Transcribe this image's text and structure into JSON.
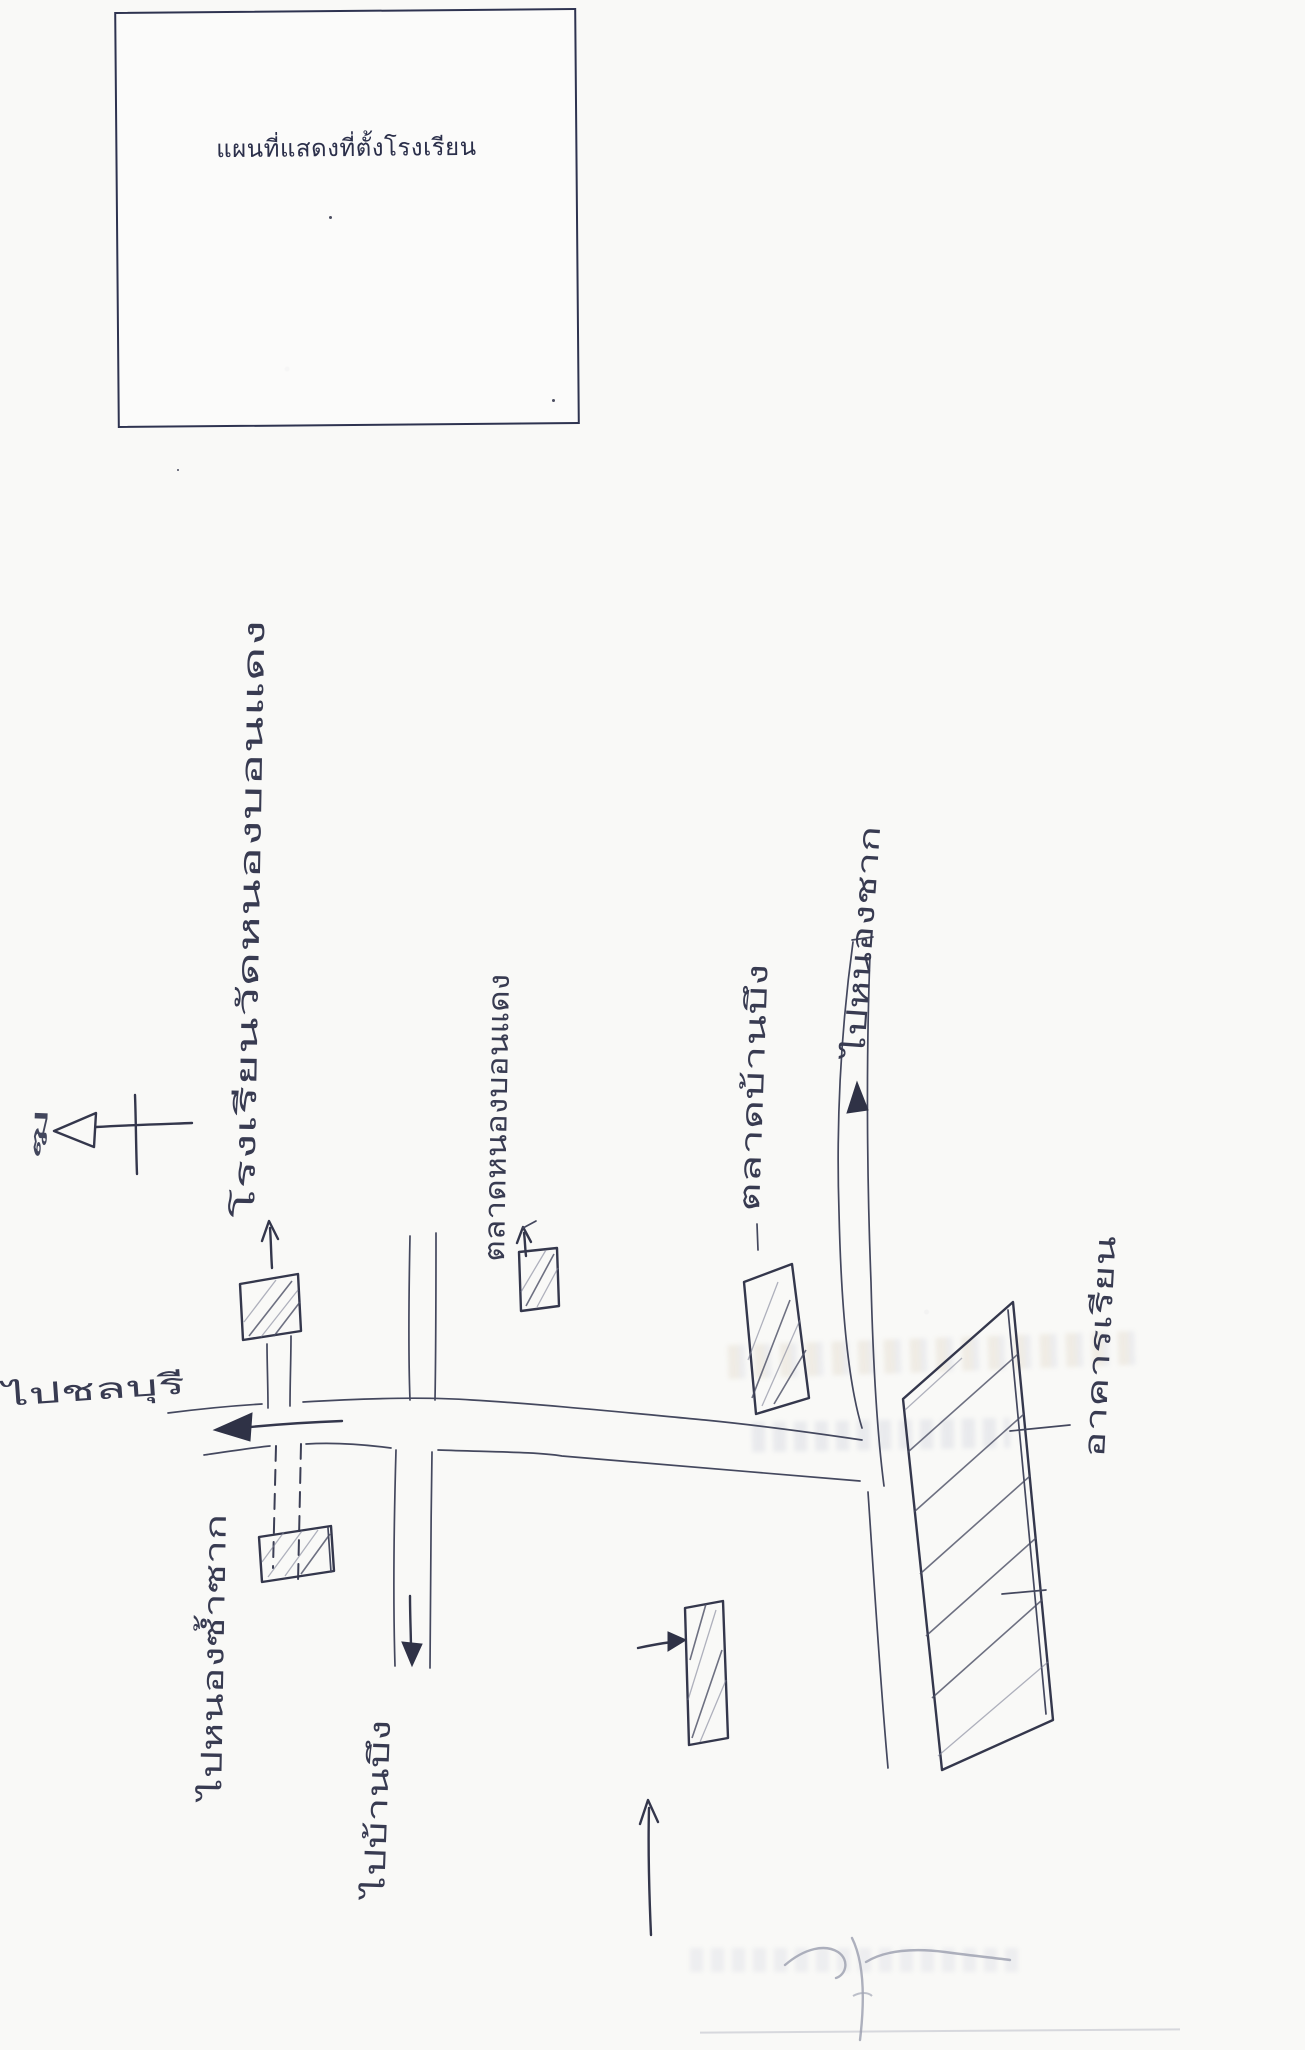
{
  "page": {
    "kind": "scanned school-location sketch map",
    "paper_color": "#f9f9f7",
    "ink_color": "#34374c"
  },
  "title_box": {
    "title": "แผนที่แสดงที่ตั้งโรงเรียน"
  },
  "map": {
    "labels": {
      "school_name": "โรงเรียนวัดหนองบอนแดง",
      "market_center": "ตลาดหนองบอนแดง",
      "market_right": "ตลาดบ้านบึง",
      "road_west": "ไปชลบุรี",
      "road_north": "ไปหนองชาก",
      "road_south": "ไปบ้านบึง",
      "road_southwest": "ไปหนองซ้ำซาก",
      "school_building": "อาคารเรียน",
      "north_mark": "ฆ"
    },
    "icons": [
      "north-arrow-icon",
      "arrow-left-icon",
      "arrow-up-icon",
      "arrow-down-icon",
      "arrow-right-icon"
    ],
    "buildings_count": 6
  }
}
